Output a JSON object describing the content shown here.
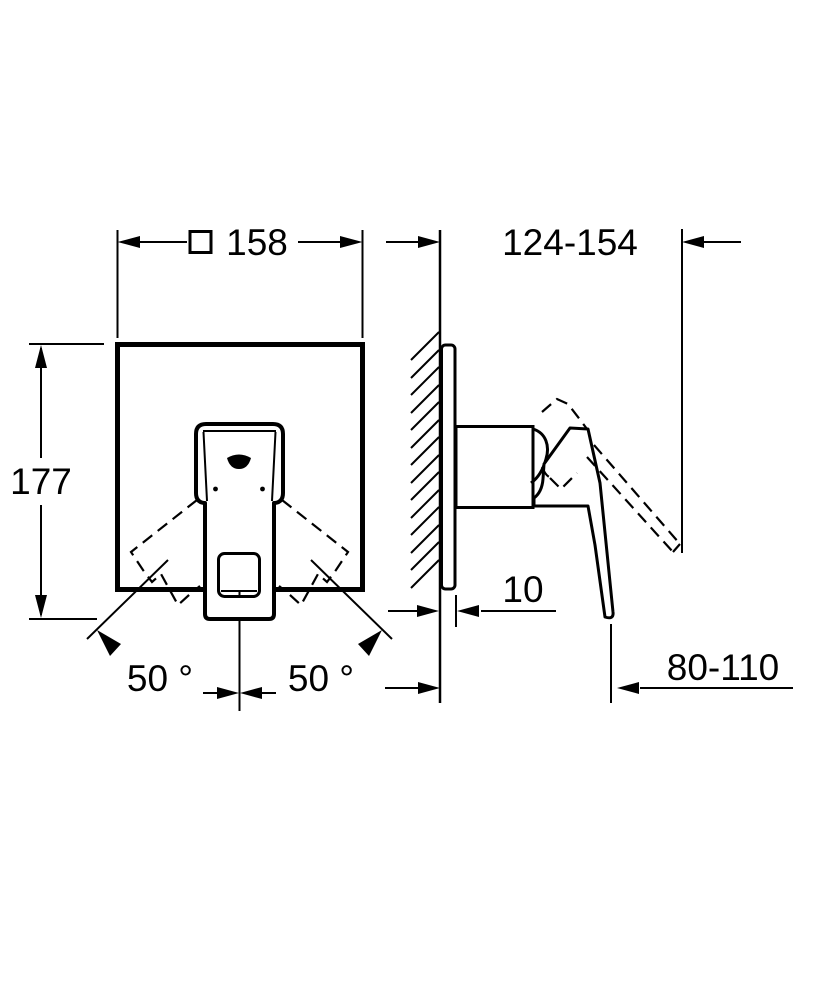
{
  "drawing": {
    "background_color": "#ffffff",
    "line_color": "#000000",
    "front_view": {
      "dimensions": {
        "plate_width": {
          "symbol_icon": "square-symbol",
          "value": "158"
        },
        "overall_height": {
          "value": "177"
        },
        "swing_angle_left": {
          "value": "50 °"
        },
        "swing_angle_right": {
          "value": "50 °"
        }
      }
    },
    "side_view": {
      "dimensions": {
        "handle_up_reach": {
          "value": "124-154"
        },
        "plate_depth": {
          "value": "10"
        },
        "handle_down_reach": {
          "value": "80-110"
        }
      }
    }
  }
}
